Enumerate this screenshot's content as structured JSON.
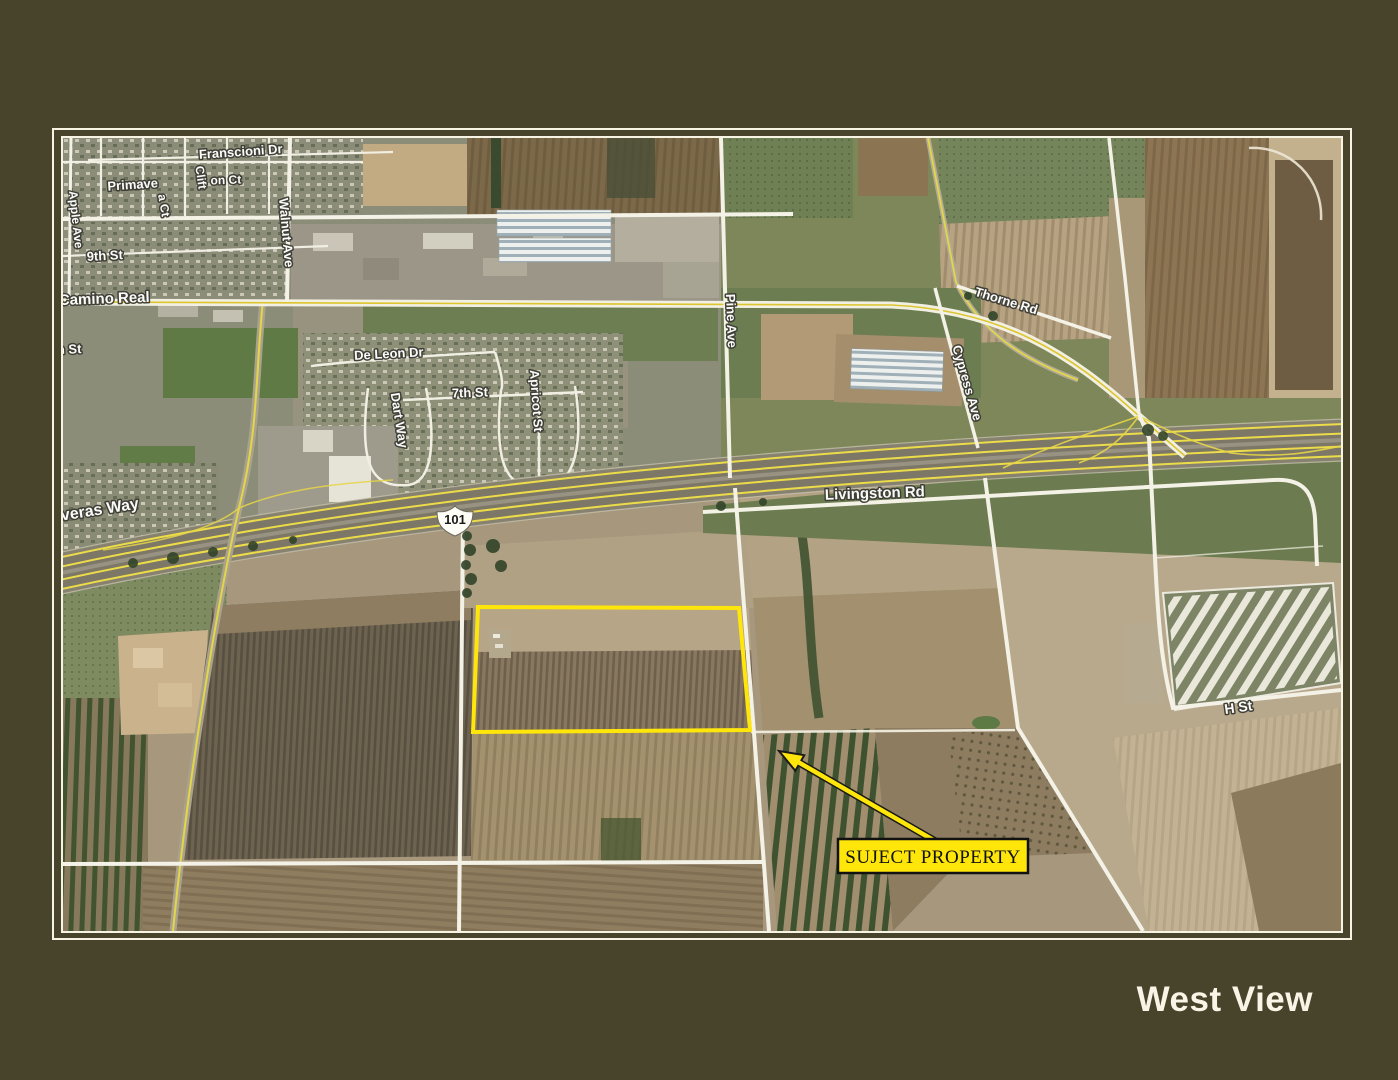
{
  "page": {
    "background": "#48432b",
    "title": "West View",
    "title_color": "#f8f4e6"
  },
  "frame": {
    "line_color": "#f7f4e4"
  },
  "map": {
    "colors": {
      "subject_yellow": "#ffe60a",
      "highway_yellow": "#ecdc4a",
      "road_white": "#f4f2e6",
      "label_fill": "#ffffff",
      "label_halo": "#3c3c34",
      "field_tan": "#a6977d",
      "field_green": "#6d7d52"
    },
    "shield": {
      "text": "101",
      "x": 392,
      "y": 382
    },
    "labels": [
      {
        "text": "Franscioni Dr",
        "x": 178,
        "y": 18,
        "rot": -4,
        "size": 13
      },
      {
        "text": "Clift",
        "x": 134,
        "y": 40,
        "rot": 82,
        "size": 12
      },
      {
        "text": "on Ct",
        "x": 163,
        "y": 46,
        "rot": -2,
        "size": 12
      },
      {
        "text": "Primave",
        "x": 70,
        "y": 51,
        "rot": -4,
        "size": 13
      },
      {
        "text": "a Ct",
        "x": 97,
        "y": 68,
        "rot": 80,
        "size": 12
      },
      {
        "text": "Apple Ave",
        "x": 9,
        "y": 82,
        "rot": 84,
        "size": 12
      },
      {
        "text": "9th St",
        "x": 42,
        "y": 122,
        "rot": -3,
        "size": 13
      },
      {
        "text": "Camino Real",
        "x": -4,
        "y": 167,
        "rot": -2,
        "size": 15,
        "anchor": "start"
      },
      {
        "text": "h St",
        "x": -6,
        "y": 216,
        "rot": -2,
        "size": 13,
        "anchor": "start"
      },
      {
        "text": "Walnut Ave",
        "x": 219,
        "y": 95,
        "rot": 85,
        "size": 13
      },
      {
        "text": "De Leon Dr",
        "x": 326,
        "y": 220,
        "rot": -3,
        "size": 13
      },
      {
        "text": "7th St",
        "x": 407,
        "y": 259,
        "rot": -2,
        "size": 13
      },
      {
        "text": "Dart Way",
        "x": 332,
        "y": 283,
        "rot": 81,
        "size": 13
      },
      {
        "text": "Apricot St",
        "x": 469,
        "y": 263,
        "rot": 86,
        "size": 13
      },
      {
        "text": "Pine Ave",
        "x": 664,
        "y": 183,
        "rot": 88,
        "size": 13
      },
      {
        "text": "Thorne Rd",
        "x": 942,
        "y": 167,
        "rot": 17,
        "size": 13
      },
      {
        "text": "Cypress Ave",
        "x": 900,
        "y": 246,
        "rot": 74,
        "size": 13
      },
      {
        "text": "Livingston Rd",
        "x": 812,
        "y": 360,
        "rot": -2,
        "size": 15
      },
      {
        "text": "averas Way",
        "x": -10,
        "y": 384,
        "rot": -9,
        "size": 16,
        "anchor": "start"
      },
      {
        "text": "H St",
        "x": 1176,
        "y": 574,
        "rot": -8,
        "size": 14
      }
    ],
    "subject": {
      "label": "SUJECT PROPERTY",
      "outline_points": "415,469 676,470 687,592 410,594",
      "arrow": {
        "x1": 872,
        "y1": 703,
        "x2": 716,
        "y2": 613
      },
      "box": {
        "x": 775,
        "y": 701,
        "w": 190,
        "h": 34
      }
    }
  }
}
